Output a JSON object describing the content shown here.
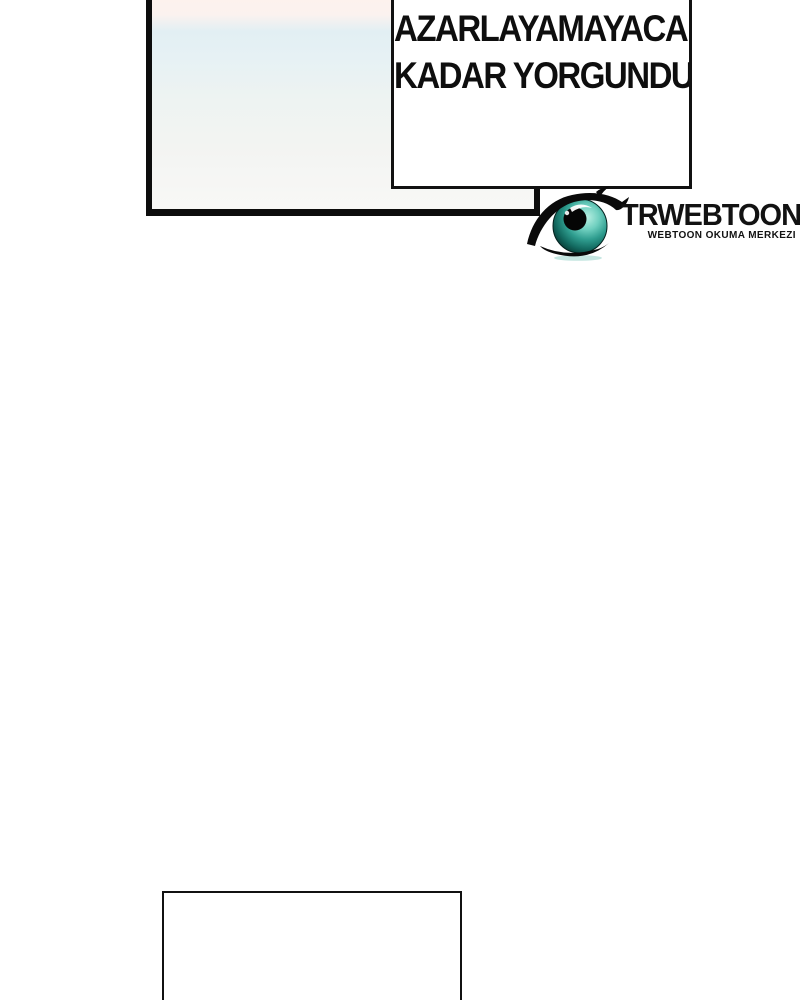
{
  "page": {
    "background": "#ffffff",
    "type": "webtoon-comic-page"
  },
  "speech_bubble": {
    "lines": [
      "AZARLAYAMAYACAK",
      "KADAR YORGUNDUM,"
    ]
  },
  "watermark": {
    "brand": "TRWEBTOON",
    "tagline": "WEBTOON OKUMA MERKEZI",
    "icon": "eye-icon"
  },
  "colors": {
    "panel_border": "#0d0d0d",
    "sky_top_pink": "#fdf2ed",
    "sky_blue_band": "#e4f0f4",
    "sky_bottom": "#f8f8f6",
    "iris_light": "#b8efe2",
    "iris_mid": "#2f9d8f",
    "iris_dark": "#06332e",
    "logo_text": "#121212"
  }
}
